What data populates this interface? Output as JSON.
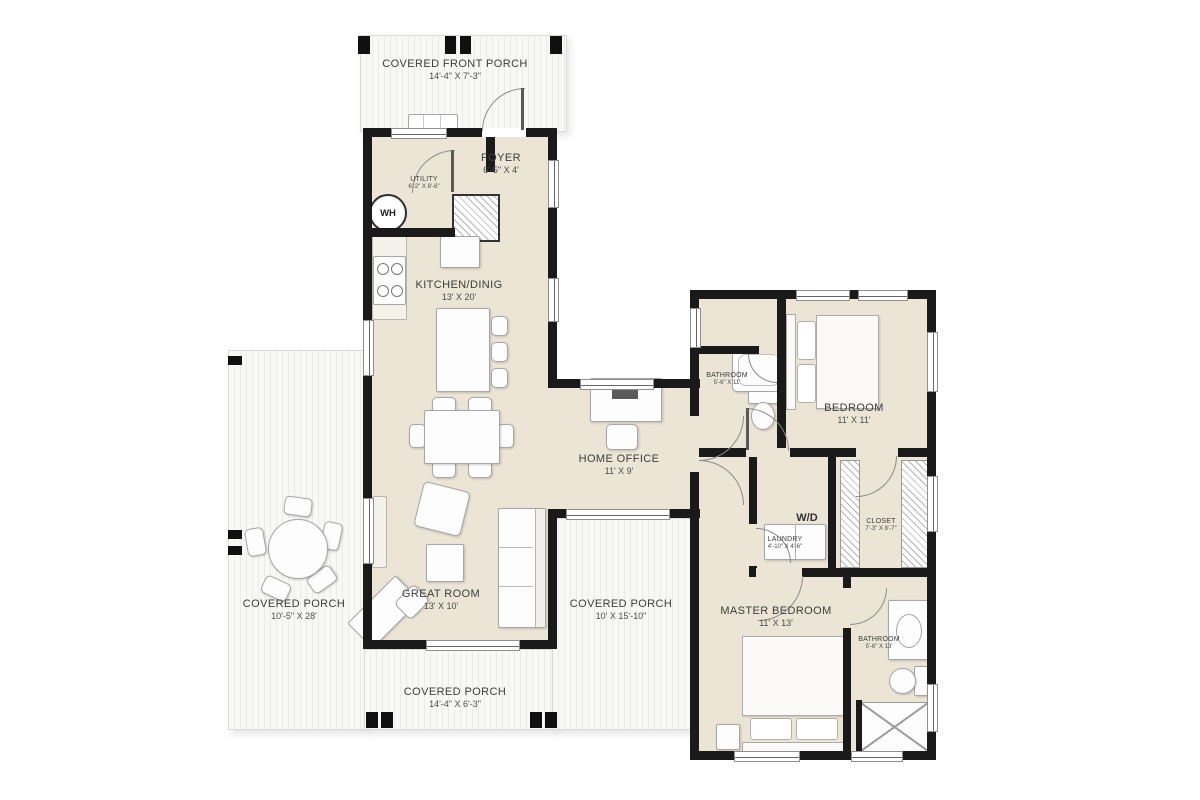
{
  "plan": {
    "type": "floor-plan",
    "rooms": {
      "front_porch": {
        "name": "COVERED FRONT PORCH",
        "dims": "14'-4\" X 7'-3\""
      },
      "foyer": {
        "name": "FOYER",
        "dims": "6'-5\" X 4'"
      },
      "utility": {
        "name": "UTILITY",
        "dims": "6'-2\" X 8'-6\""
      },
      "kitchen_dining": {
        "name": "KITCHEN/DINIG",
        "dims": "13' X 20'"
      },
      "bathroom_1": {
        "name": "BATHROOM",
        "dims": "5'-6\" X 11'"
      },
      "bedroom": {
        "name": "BEDROOM",
        "dims": "11' X 11'"
      },
      "home_office": {
        "name": "HOME OFFICE",
        "dims": "11' X 9'"
      },
      "laundry": {
        "name": "LAUNDRY",
        "dims": "4'-10\" X 4'-6\""
      },
      "closet": {
        "name": "CLOSET",
        "dims": "7'-3\" X 8'-7\""
      },
      "great_room": {
        "name": "GREAT ROOM",
        "dims": "13' X 10'"
      },
      "covered_porch_left": {
        "name": "COVERED PORCH",
        "dims": "10'-5\" X 28'"
      },
      "covered_porch_mid": {
        "name": "COVERED PORCH",
        "dims": "10' X 15'-10\""
      },
      "master_bedroom": {
        "name": "MASTER BEDROOM",
        "dims": "11' X 13'"
      },
      "bathroom_2": {
        "name": "BATHROOM",
        "dims": "5'-6\" X 13'"
      },
      "covered_porch_bottom": {
        "name": "COVERED PORCH",
        "dims": "14'-4\" X 6'-3\""
      }
    },
    "fixtures": {
      "water_heater": "WH",
      "washer_dryer": "W/D"
    },
    "colors": {
      "wall": "#1a1a1a",
      "floor": "#ece4d5",
      "deck": "#f6f6f5",
      "deck_stripe": "#e9e9e7",
      "label_text": "#3d3d3d"
    }
  }
}
